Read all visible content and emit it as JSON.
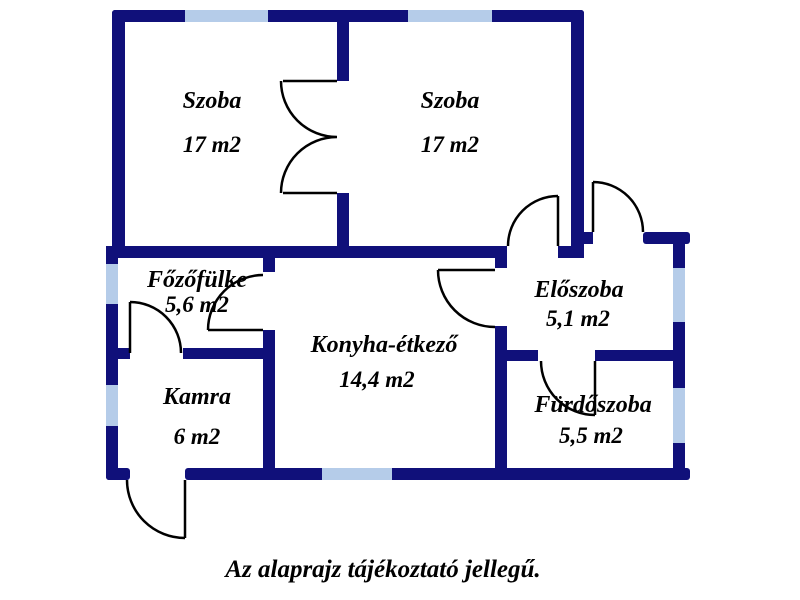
{
  "caption": "Az alaprajz tájékoztató jellegű.",
  "colors": {
    "wall": "#10107a",
    "window": "#b5cce9",
    "door": "#000000",
    "text": "#000000",
    "background": "#ffffff"
  },
  "rooms": [
    {
      "id": "szoba-left",
      "name": "Szoba",
      "area": "17 m2"
    },
    {
      "id": "szoba-right",
      "name": "Szoba",
      "area": "17 m2"
    },
    {
      "id": "fozofulke",
      "name": "Főzőfülke",
      "area": "5,6 m2"
    },
    {
      "id": "konyha",
      "name": "Konyha-étkező",
      "area": "14,4 m2"
    },
    {
      "id": "kamra",
      "name": "Kamra",
      "area": "6 m2"
    },
    {
      "id": "eloszoba",
      "name": "Előszoba",
      "area": "5,1 m2"
    },
    {
      "id": "furdoszoba",
      "name": "Fürdőszoba",
      "area": "5,5 m2"
    }
  ]
}
